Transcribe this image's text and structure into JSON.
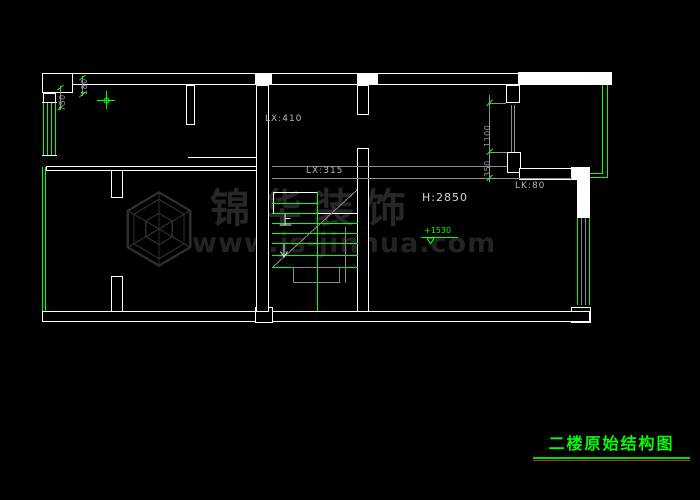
{
  "canvas": {
    "background": "#000000"
  },
  "watermark": {
    "brand": "锦华装饰",
    "url": "www.js-jinhua.com"
  },
  "plan": {
    "labels": {
      "beam_top": "LX:410",
      "beam_mid": "LX:315",
      "beam_right": "LK:80",
      "room_height": "H:2850",
      "elevation": "+1530",
      "stair_up": "上"
    },
    "dims": {
      "d750": "750",
      "d180": "180",
      "d1100": "1100",
      "d350": "350"
    }
  },
  "title_block": {
    "title": "二楼原始结构图"
  },
  "colors": {
    "wall": "#ffffff",
    "window_green": "#00ff00",
    "dimension_gray": "#8f8f8f",
    "label_text": "#b5b5b5",
    "title_green": "#00ff00",
    "title_accent_red": "#a03434",
    "watermark_gray": "#272727"
  }
}
